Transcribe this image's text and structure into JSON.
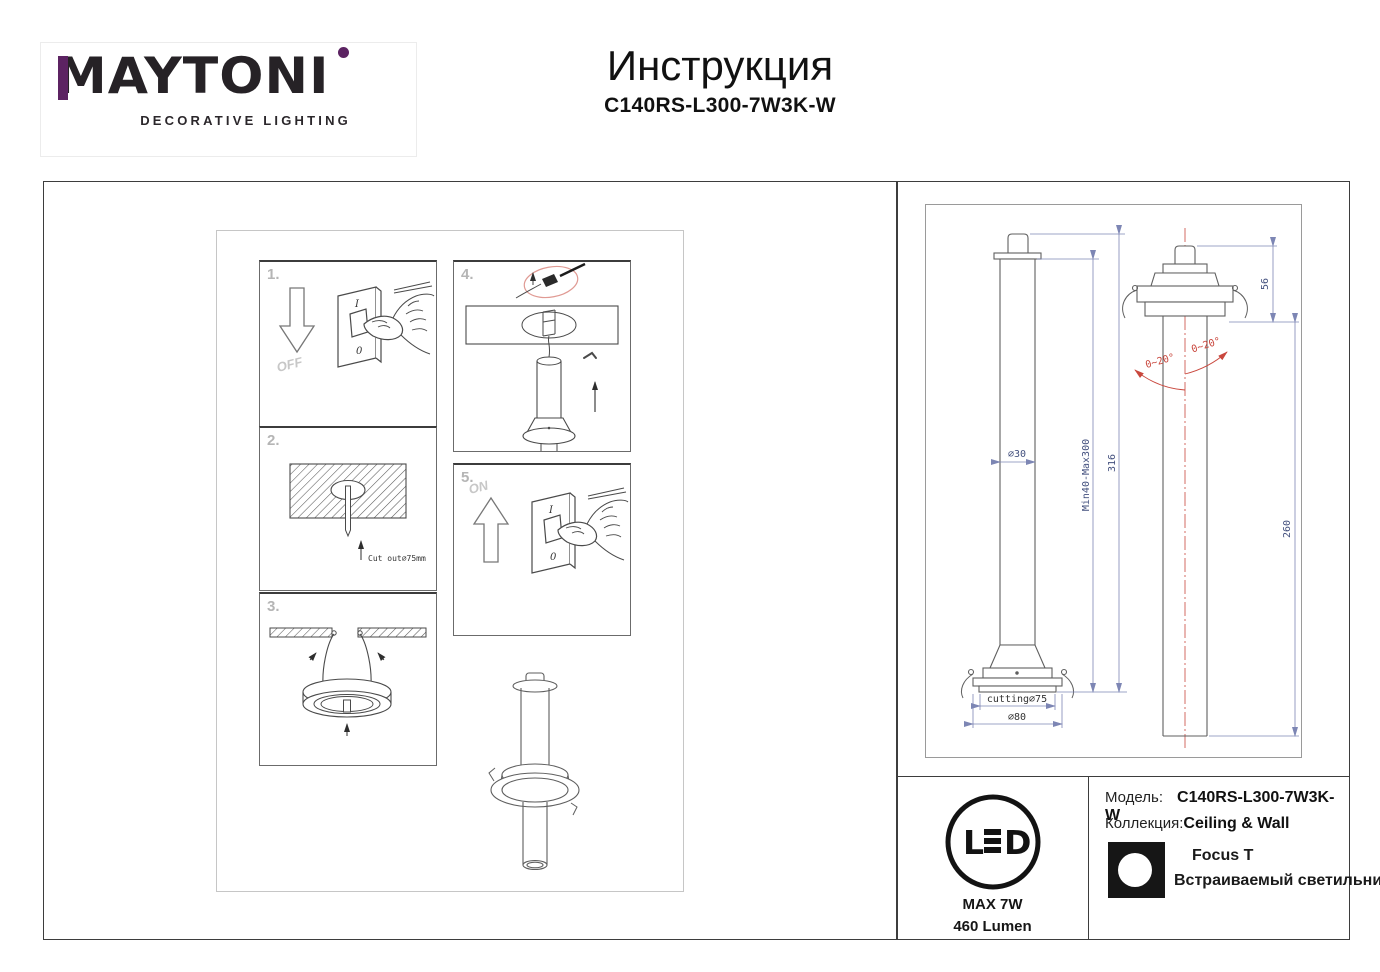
{
  "header": {
    "brand": "MAYTONI",
    "tagline": "DECORATIVE LIGHTING",
    "title": "Инструкция",
    "model_code": "C140RS-L300-7W3K-W",
    "accent_color": "#5c2362"
  },
  "steps": {
    "s1": {
      "num": "1.",
      "label": "OFF",
      "switch_top": "I",
      "switch_bottom": "0"
    },
    "s2": {
      "num": "2.",
      "label": "Cut out∅75mm"
    },
    "s3": {
      "num": "3."
    },
    "s4": {
      "num": "4."
    },
    "s5": {
      "num": "5.",
      "label": "ON",
      "switch_top": "I",
      "switch_bottom": "0"
    }
  },
  "drawing": {
    "dims": {
      "tube_diameter": "∅30",
      "suspension_range": "Min40-Max300",
      "total_height": "316",
      "cutout": "cutting∅75",
      "flange_diameter": "∅80",
      "recess_height": "56",
      "tube_length": "260",
      "tilt_left": "0~20°",
      "tilt_right": "0~20°"
    },
    "colors": {
      "dimension": "#7d86b4",
      "annotation": "#c9473d"
    }
  },
  "footer": {
    "led": {
      "l": "L",
      "d": "D",
      "max_power": "MAX 7W",
      "lumen": "460 Lumen"
    },
    "model_label": "Модель:",
    "model_value": "C140RS-L300-7W3K-W",
    "collection_label": "Коллекция:",
    "collection_value": "Ceiling & Wall",
    "series": "Focus T",
    "product_type": "Встраиваемый светильник"
  }
}
